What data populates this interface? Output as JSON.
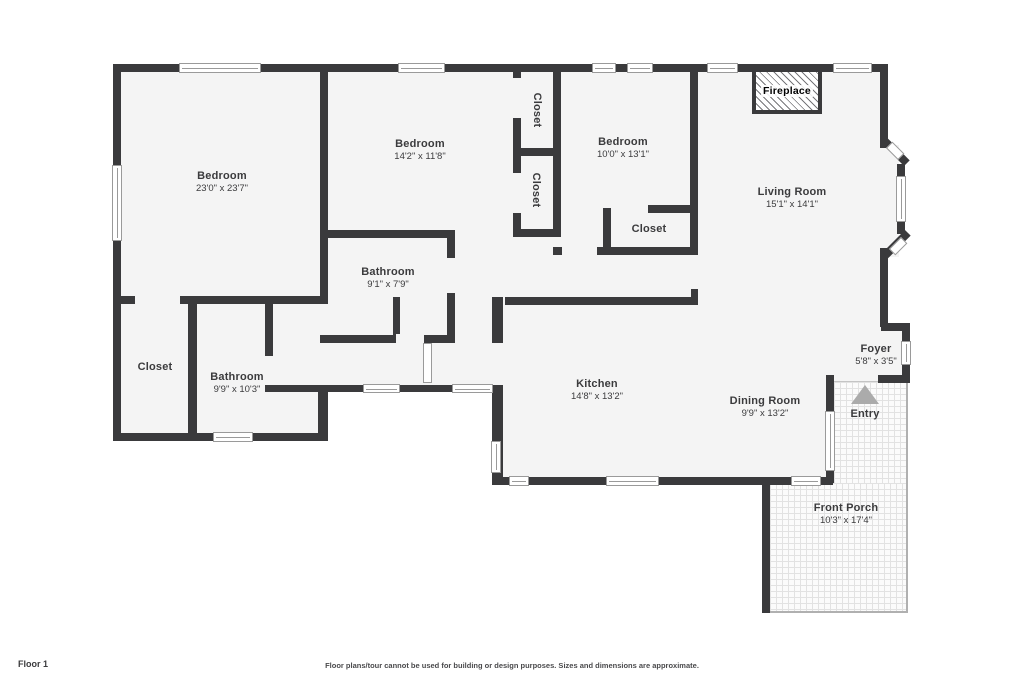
{
  "plan": {
    "rooms": {
      "bedroom_master": {
        "name": "Bedroom",
        "dims": "23'0\" x 23'7\""
      },
      "bedroom_middle": {
        "name": "Bedroom",
        "dims": "14'2\" x 11'8\""
      },
      "bedroom_right": {
        "name": "Bedroom",
        "dims": "10'0\" x 13'1\""
      },
      "living_room": {
        "name": "Living Room",
        "dims": "15'1\" x 14'1\""
      },
      "bathroom_hall": {
        "name": "Bathroom",
        "dims": "9'1\" x 7'9\""
      },
      "bathroom_master": {
        "name": "Bathroom",
        "dims": "9'9\" x 10'3\""
      },
      "kitchen": {
        "name": "Kitchen",
        "dims": "14'8\" x 13'2\""
      },
      "dining_room": {
        "name": "Dining Room",
        "dims": "9'9\" x 13'2\""
      },
      "foyer": {
        "name": "Foyer",
        "dims": "5'8\" x 3'5\""
      },
      "front_porch": {
        "name": "Front Porch",
        "dims": "10'3\" x 17'4\""
      },
      "closet_hall_top": {
        "name": "Closet"
      },
      "closet_hall_bottom": {
        "name": "Closet"
      },
      "closet_bedroom_right": {
        "name": "Closet"
      },
      "closet_master": {
        "name": "Closet"
      },
      "fireplace": {
        "name": "Fireplace"
      },
      "entry": {
        "name": "Entry"
      }
    },
    "colors": {
      "wall": "#3a3a3c",
      "room_fill": "#f4f4f4",
      "window_frame": "#9a9a9a",
      "porch_border": "#b0b0b0",
      "entry_arrow": "#ababab"
    }
  },
  "footer": {
    "floor_label": "Floor 1",
    "disclaimer": "Floor plans/tour cannot be used for building or design purposes. Sizes and dimensions are approximate."
  }
}
